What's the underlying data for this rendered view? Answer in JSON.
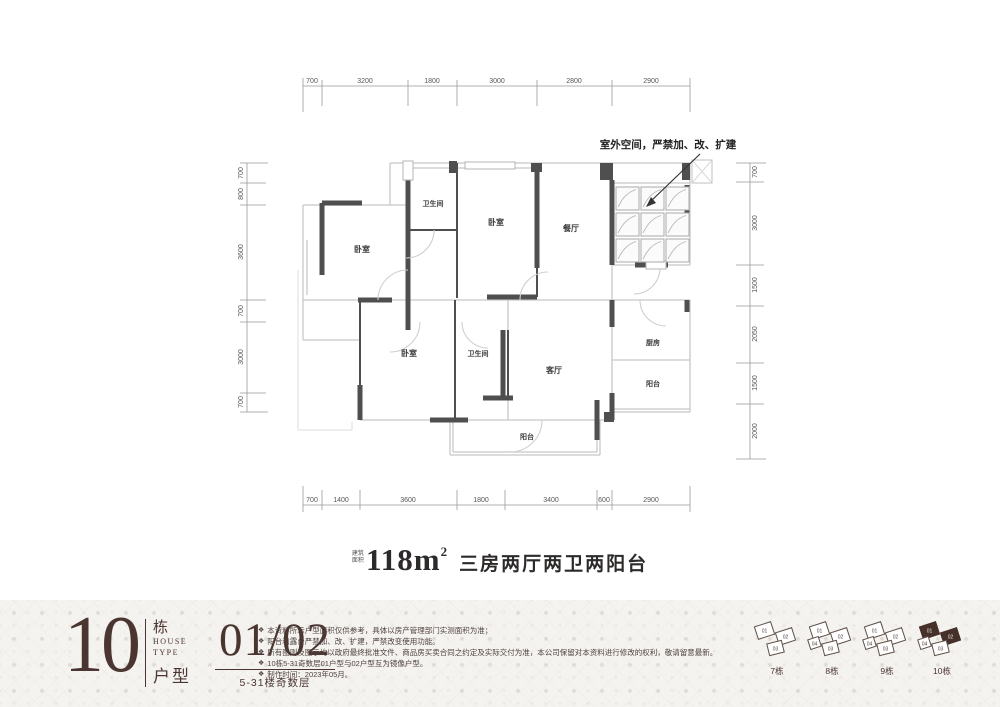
{
  "colors": {
    "accent": "#4a3531",
    "wall": "#4f4f4f",
    "light_line": "#c8c8c8",
    "highlight": "#46302a",
    "footer_bg": "#f5f3f0"
  },
  "plan": {
    "annotation": "室外空间，严禁加、改、扩建",
    "rooms": {
      "bedroom1": "卧室",
      "bath1": "卫生间",
      "bedroom2": "卧室",
      "dining": "餐厅",
      "bedroom3": "卧室",
      "bath2": "卫生间",
      "living": "客厅",
      "kitchen": "厨房",
      "balcony_right": "阳台",
      "balcony_bottom": "阳台"
    },
    "dims": {
      "top": [
        "700",
        "3200",
        "1800",
        "3000",
        "2800",
        "2900"
      ],
      "bottom": [
        "700",
        "1400",
        "3600",
        "1800",
        "3400",
        "600",
        "2900"
      ],
      "left": [
        "700",
        "800",
        "3600",
        "700",
        "3000",
        "700"
      ],
      "right": [
        "700",
        "3000",
        "1500",
        "2050",
        "1500",
        "2000"
      ]
    }
  },
  "area": {
    "prefix_line1": "建筑",
    "prefix_line2": "面积",
    "value": "118m",
    "sup": "2",
    "desc": "三房两厅两卫两阳台"
  },
  "footer": {
    "block_number": "10",
    "block_unit": "栋",
    "house": "HOUSE",
    "type": "TYPE",
    "huxing": "户型",
    "units": "01/02",
    "floors": "5-31楼奇数层",
    "bullet": "❖",
    "notes": [
      "本资料所示户型面积仅供参考，具体以房产管理部门实测面积为准；",
      "阳台和露台严禁加、改、扩建，严禁改变使用功能。",
      "所有图则及图示均以政府最终批准文件、商品房买卖合同之约定及实际交付为准，本公司保留对本资料进行修改的权利，敬请留意最新。",
      "10栋5-31奇数层01户型与02户型互为镜像户型。",
      "制作时间：2023年05月。"
    ],
    "keys": [
      {
        "caption": "7栋",
        "u1": "01",
        "u2": "02",
        "u3": "03"
      },
      {
        "caption": "8栋",
        "u1": "01",
        "u2": "02",
        "u3": "03",
        "u4": "04"
      },
      {
        "caption": "9栋",
        "u1": "01",
        "u2": "02",
        "u3": "03",
        "u4": "04"
      },
      {
        "caption": "10栋",
        "u1": "01",
        "u2": "02",
        "u3": "03",
        "u4": "04"
      }
    ]
  }
}
